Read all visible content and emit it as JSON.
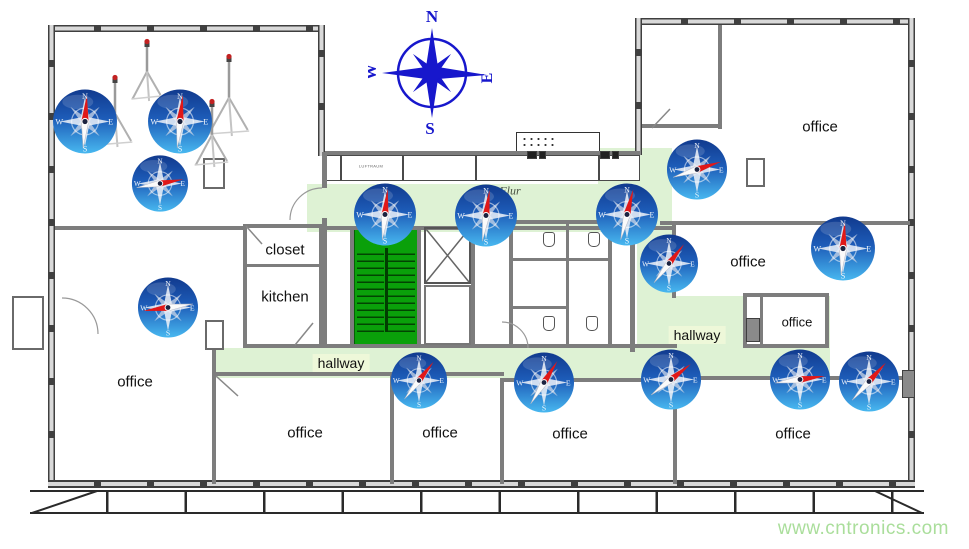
{
  "watermark": "www.cntronics.com",
  "compass_rose": {
    "letters": {
      "n": "N",
      "e": "E",
      "s": "S",
      "w": "W"
    }
  },
  "compass_letters": {
    "n": "N",
    "e": "E",
    "s": "S",
    "w": "W"
  },
  "labels": [
    {
      "text": "office",
      "x": 820,
      "y": 127,
      "cls": "room"
    },
    {
      "text": "office",
      "x": 748,
      "y": 262,
      "cls": "room"
    },
    {
      "text": "office",
      "x": 797,
      "y": 322,
      "cls": "room-sm"
    },
    {
      "text": "office",
      "x": 135,
      "y": 382,
      "cls": "room"
    },
    {
      "text": "office",
      "x": 305,
      "y": 433,
      "cls": "room"
    },
    {
      "text": "office",
      "x": 440,
      "y": 433,
      "cls": "room"
    },
    {
      "text": "office",
      "x": 570,
      "y": 434,
      "cls": "room"
    },
    {
      "text": "office",
      "x": 793,
      "y": 434,
      "cls": "room"
    },
    {
      "text": "closet",
      "x": 285,
      "y": 250,
      "cls": "room"
    },
    {
      "text": "kitchen",
      "x": 285,
      "y": 297,
      "cls": "room"
    },
    {
      "text": "hallway",
      "x": 341,
      "y": 363,
      "cls": "hall"
    },
    {
      "text": "hallway",
      "x": 697,
      "y": 335,
      "cls": "hall"
    },
    {
      "text": "Flur",
      "x": 510,
      "y": 191,
      "cls": "flur"
    },
    {
      "text": "LUFTRAUM",
      "x": 371,
      "y": 166,
      "cls": "tiny"
    }
  ],
  "compasses": [
    {
      "x": 85,
      "y": 124,
      "size": 66,
      "angle": 4
    },
    {
      "x": 180,
      "y": 124,
      "size": 66,
      "angle": 6
    },
    {
      "x": 160,
      "y": 186,
      "size": 58,
      "angle": 80
    },
    {
      "x": 168,
      "y": 310,
      "size": 62,
      "angle": 262
    },
    {
      "x": 385,
      "y": 217,
      "size": 64,
      "angle": 6
    },
    {
      "x": 486,
      "y": 218,
      "size": 64,
      "angle": 8
    },
    {
      "x": 697,
      "y": 172,
      "size": 62,
      "angle": 72
    },
    {
      "x": 627,
      "y": 217,
      "size": 64,
      "angle": 14
    },
    {
      "x": 669,
      "y": 266,
      "size": 60,
      "angle": 38
    },
    {
      "x": 843,
      "y": 251,
      "size": 66,
      "angle": 4
    },
    {
      "x": 419,
      "y": 383,
      "size": 58,
      "angle": 38
    },
    {
      "x": 544,
      "y": 385,
      "size": 62,
      "angle": 32
    },
    {
      "x": 671,
      "y": 382,
      "size": 62,
      "angle": 52
    },
    {
      "x": 800,
      "y": 382,
      "size": 62,
      "angle": 82
    },
    {
      "x": 869,
      "y": 384,
      "size": 62,
      "angle": 42
    }
  ],
  "tripods": [
    {
      "x": 147,
      "y": 43,
      "h": 52
    },
    {
      "x": 115,
      "y": 79,
      "h": 62
    },
    {
      "x": 229,
      "y": 58,
      "h": 72
    },
    {
      "x": 212,
      "y": 103,
      "h": 58
    }
  ]
}
